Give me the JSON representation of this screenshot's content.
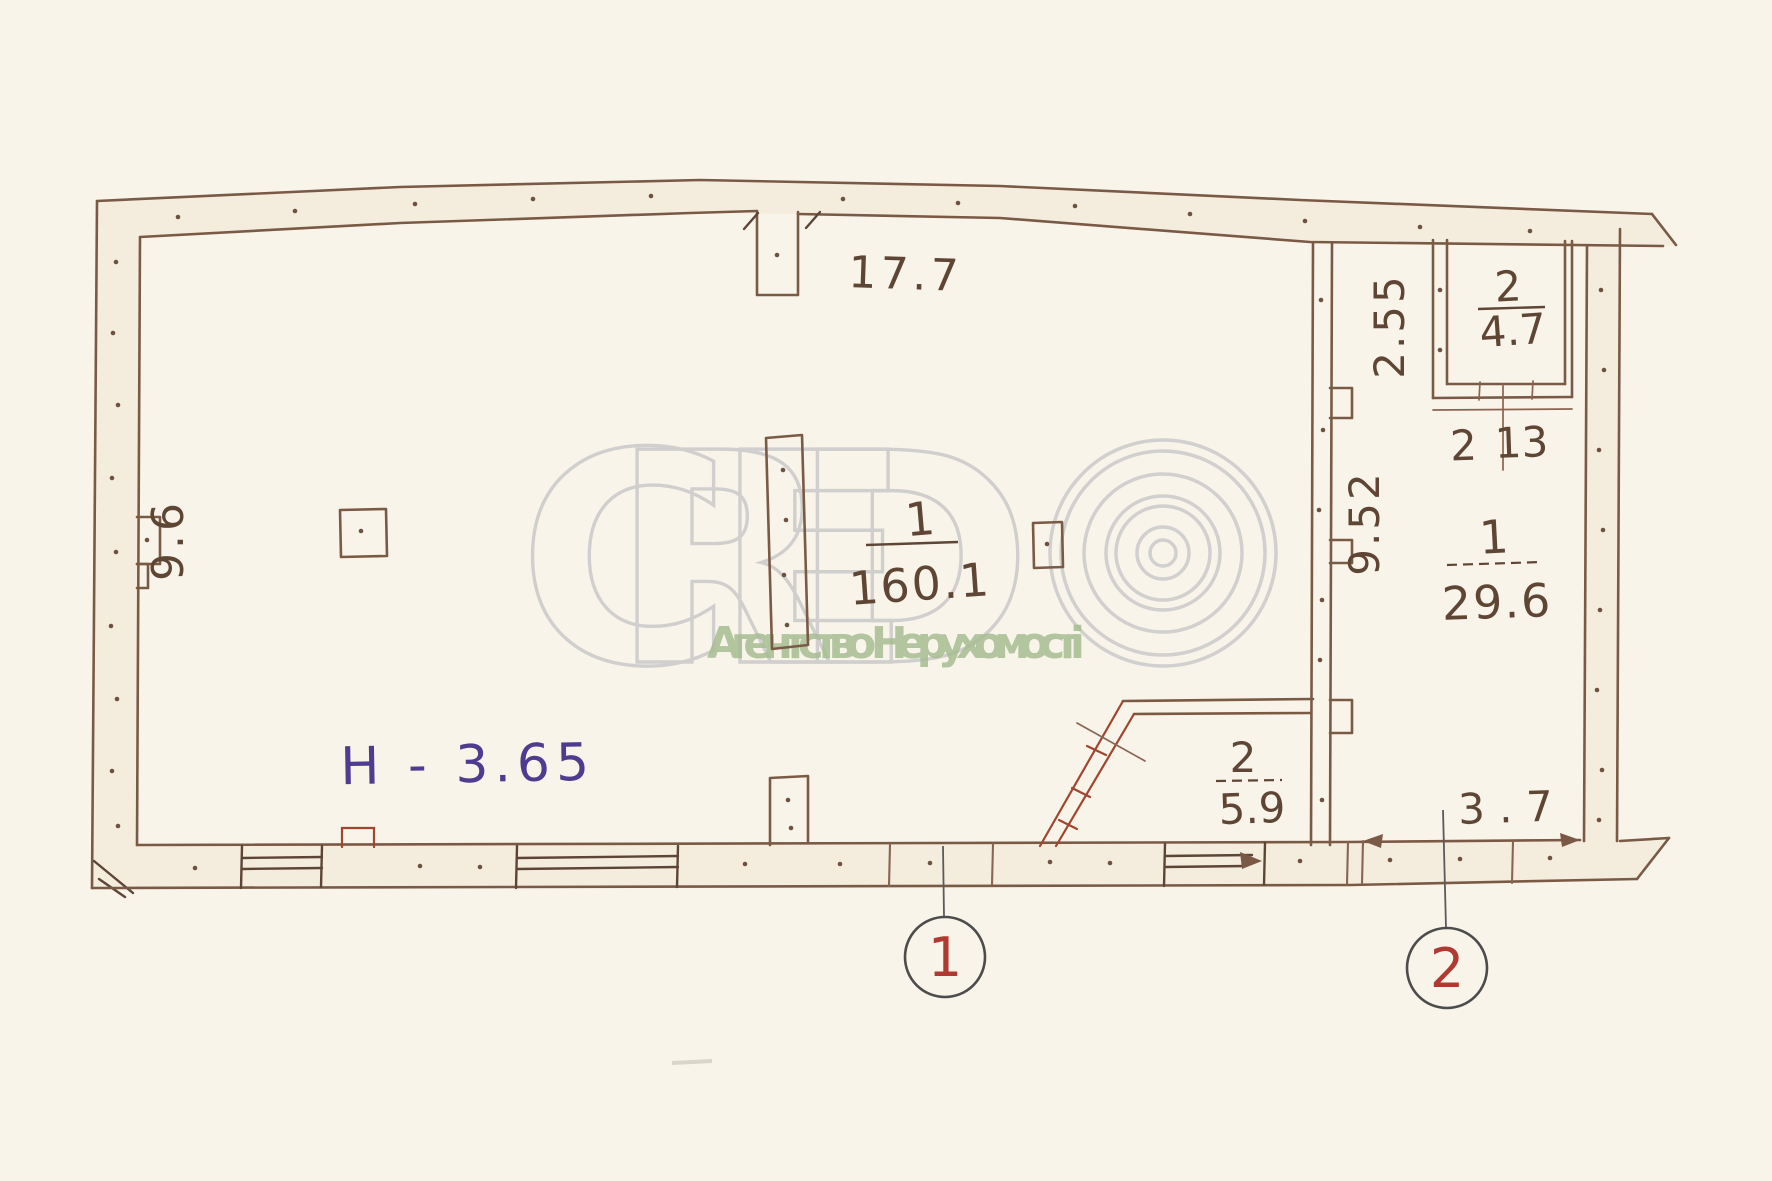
{
  "meta": {
    "type": "scanned hand-drawn floor plan"
  },
  "watermark": {
    "brand": "CRED",
    "copyright_symbol": "©",
    "agency": "Агентство Нерухомості"
  },
  "plan": {
    "height_note": "H - 3.65",
    "rooms": {
      "main": {
        "number": "1",
        "area": "160.1"
      },
      "right": {
        "number": "1",
        "area": "29.6"
      },
      "vestibule": {
        "number": "2",
        "area": "5.9"
      },
      "closet": {
        "number": "2",
        "area": "4.7"
      }
    },
    "dims": {
      "top": "17.7",
      "left": "9.6",
      "corridor": "2.55",
      "right_length": "9.52",
      "closet_w1": "2",
      "closet_w2": "13",
      "bottom_right": "3.7"
    },
    "markers": {
      "m1": "1",
      "m2": "2"
    }
  },
  "colors": {
    "paper": "#f8f4ea",
    "ink": "#5f4534",
    "wall": "#7a5a45",
    "accent_red": "#b03a32",
    "note_purple": "#4e3d8f",
    "marker_outline": "#4c4c4c",
    "watermark_gray": "#cccccc",
    "watermark_green": "#a6bd92"
  }
}
